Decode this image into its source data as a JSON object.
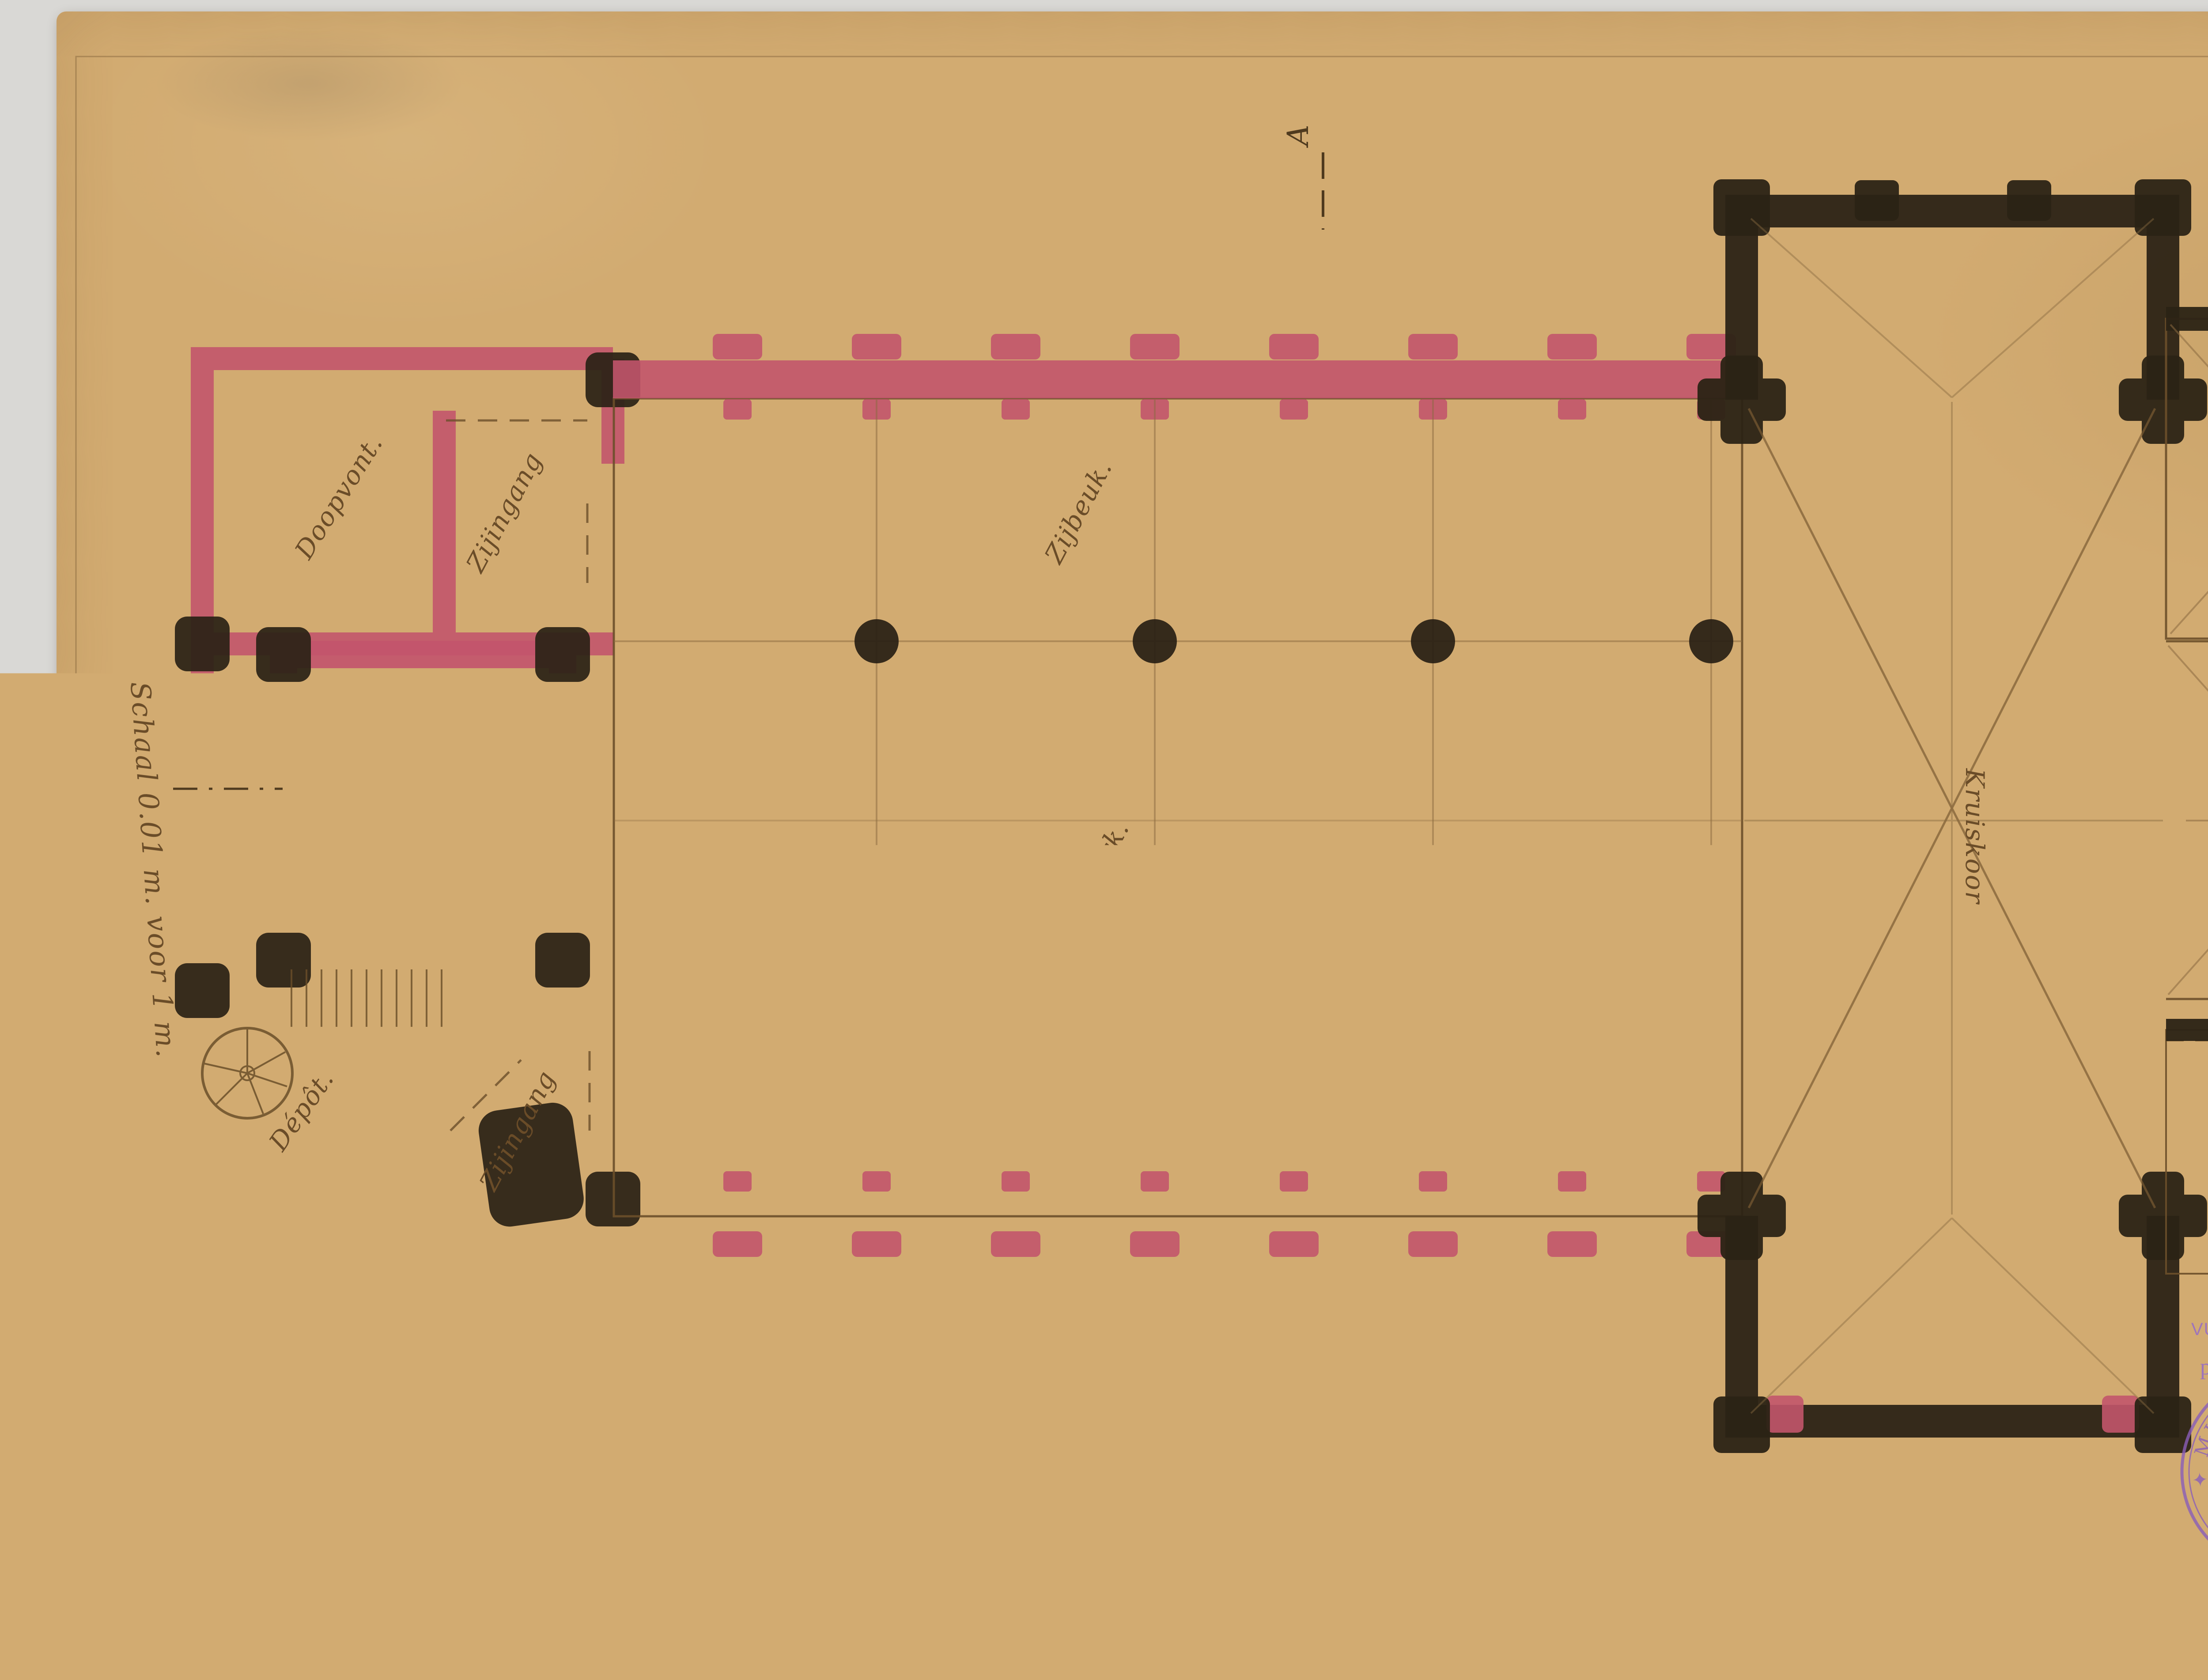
{
  "page": {
    "plate_label": "Pl. 1"
  },
  "palette": {
    "paper": "#d2ab71",
    "ink_brown": "#6b4f2a",
    "wall_pink": "#c2556c",
    "wall_black": "#2c2316",
    "stamp_red": "#b2414d",
    "stamp_purple": "#9a6fc2",
    "stamp_black": "#5c544a",
    "signature_teal": "#35656e",
    "handwriting_red": "#c24545"
  },
  "annotations": {
    "scale_note": "Schaal 0.01 m. voor 1 m.",
    "title_line1": "Vergrooting der Kerk",
    "title_line2": "te Gheel.",
    "section_a": "A",
    "section_b": "B",
    "section_c": "C",
    "section_d": "D"
  },
  "plan": {
    "rooms": {
      "doopvont": "Doopvont.",
      "zijingang_north": "Zijingang",
      "ingang": "Ingang",
      "depot_west": "Dépôt.",
      "zijingang_south": "Zijingang",
      "zijbeuk_north": "Zijbeuk.",
      "kerk": "Kerk.",
      "zijbeuk_south": "Zijbeuk.",
      "kruiskoor": "Kruiskoor",
      "koor": "Koor",
      "depot_east": "Dépôt.",
      "sacristij": "Sacristij."
    }
  },
  "stamps": {
    "council": {
      "line1": "Gezien door den Koninklijken Raad",
      "line2": "voor Kunstgebouwen in zijne zitting van",
      "date_handwritten": "den 3 October 1908.",
      "line3": "voorbehoudingen gedaan en vermeld in het",
      "line4": "verslag van",
      "verslag_handwritten": "den 7 dezer maand, N° 2763.",
      "role_left": "Het lid-Schrijver,",
      "role_right": "De Voorzitter,",
      "signature_left": "A. Hulshout",
      "signature_right": "Ch. Lagasse de Locht"
    },
    "registry": {
      "line1": "GEBOEKT TE ANTWERPEN (ZUID)",
      "den_label": "DEN",
      "den_value": "dertienden Maart 1909",
      "deel_label": "DEEL",
      "deel_value": "208",
      "blad_label": ", BLAD",
      "blad_value": "6",
      "vak_label": ", VAK",
      "vak_value": "12.",
      "blad2_label": "BLAD",
      "blad2_value": "Zonder",
      "verzending_label": "VERZENDING",
      "ontvangen_label": "ONTVANGEN",
      "ontvangen_value": "twee franken veertig Centimen",
      "ontvanger_label": "DE ONTVANGER",
      "fee_handwritten": "f 2.40",
      "signature": "Debouckx"
    },
    "justice": {
      "fr_line1": "VU PAR NOUS, MINISTRE DE LA JUSTICE",
      "fr_line2": "pour être annexé à l'arrêté royal",
      "fr_date_handwritten": "31 mai 1909.",
      "nl_line1": "GEZIEN DOOR O",
      "nl_line2": "om gevoegd t",
      "nl_line3": "besluit van",
      "nl_date_handwritten": "31 — 9 —",
      "seal_text": "✦ MINISTERE DE LA JUSTICE ✦",
      "signature": "Léon de Lantsheere"
    },
    "extraordinary": {
      "ring_text": "A TIMBRER A L'EXTRAORDINAIRE (ANVERS)",
      "ring_text_inner": "BUITENGEWOON TE ZEGELEN (ANTWERPEN)"
    },
    "dimension": {
      "ring_text": "TIMBRE DE DIMENSION ✳ FORMAAT ZEGEL ✳",
      "value_line1": "1 Fr.",
      "value_line2": "70 c."
    }
  }
}
